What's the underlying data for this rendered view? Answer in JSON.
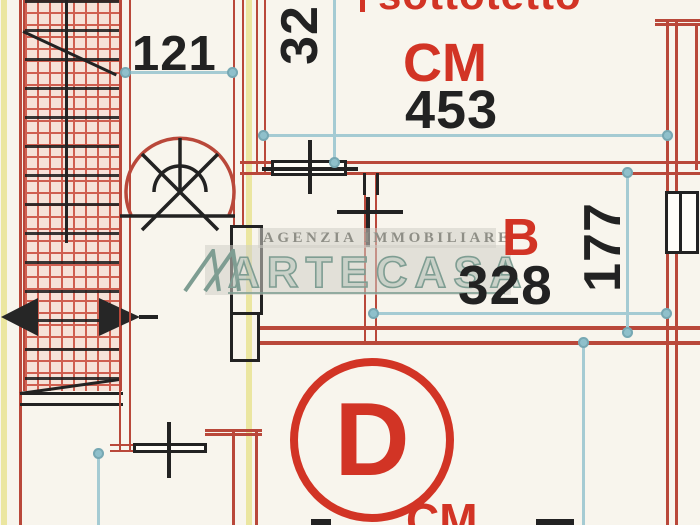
{
  "plan": {
    "area_label": "sottotetto",
    "unit_top": "CM",
    "unit_bottom": "CM",
    "rooms": {
      "b_label": "B",
      "d_label": "D"
    },
    "dims": {
      "stair_width": "121",
      "wall_offset": "32",
      "top_width": "453",
      "room_b_width": "328",
      "room_b_depth": "177"
    }
  },
  "watermark": {
    "agency": "AGENZIA IMMOBILIARE",
    "brand": "ARTECASA"
  },
  "colors": {
    "paper": "#f8f5ed",
    "wall_red": "#b9483a",
    "hatch_red": "#cf5f50",
    "hatch_bg": "#f6e2d8",
    "ink": "#222222",
    "label_red": "#d23425",
    "dim_line": "#a5cbd3",
    "dim_dot": "#8fc0cb",
    "guide_yellow": "#ebe6a0",
    "wm_teal": "#7e9d92",
    "wm_gray": "#8e8e86"
  }
}
